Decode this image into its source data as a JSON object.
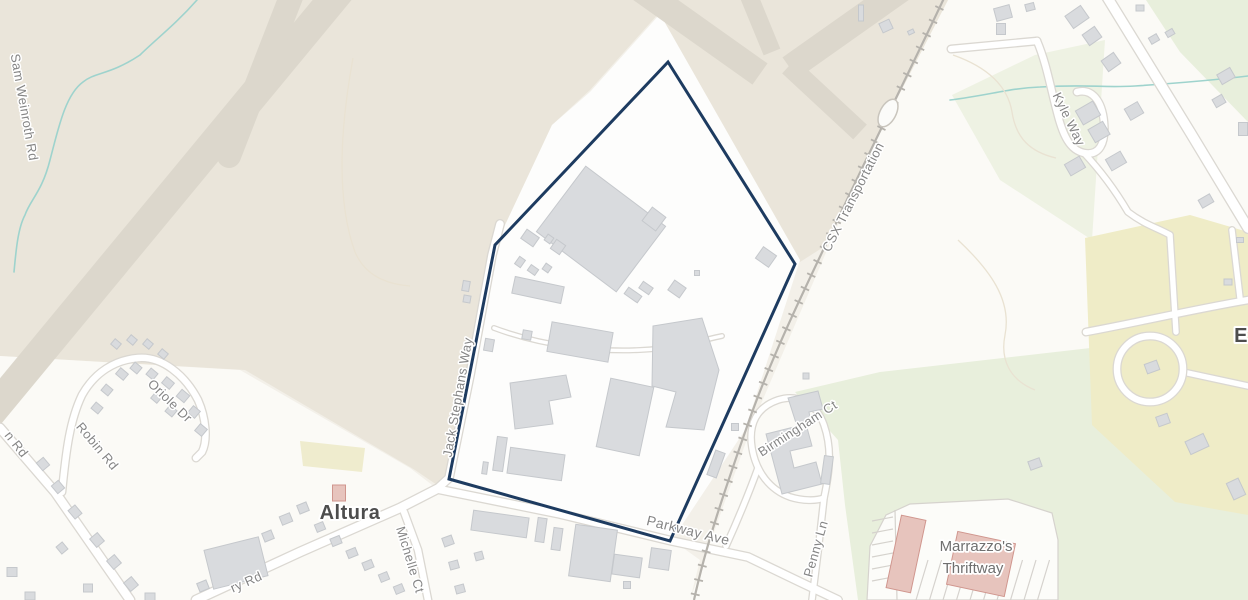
{
  "colors": {
    "base": "#f3f0e9",
    "urban": "#fbfaf6",
    "site": "#fdfdfc",
    "airport": "#eae5da",
    "runway": "#dcd7cc",
    "green": "#e8efdc",
    "green_pale": "#eef2e3",
    "yellow": "#efecc7",
    "road_fill": "#ffffff",
    "road_casing": "#dbd8d2",
    "rail": "#b5b2ac",
    "stream": "#9ed3cd",
    "contour": "#e9e2d2",
    "bld_fill": "#d9dbde",
    "bld_stroke": "#c5c8cc",
    "pink_fill": "#e7c4bd",
    "pink_stroke": "#d0968e",
    "boundary": "#1d3b60",
    "street_label": "#858585",
    "place_label": "#4d4d4d",
    "poi_label": "#6f6f6f"
  },
  "labels": {
    "place": [
      {
        "id": "altura",
        "text": "Altura"
      },
      {
        "id": "e-partial",
        "text": "E"
      }
    ],
    "streets": [
      {
        "id": "sam-weinroth-rd",
        "text": "Sam Weinroth Rd"
      },
      {
        "id": "oriole-dr",
        "text": "Oriole Dr"
      },
      {
        "id": "robin-rd",
        "text": "Robin Rd"
      },
      {
        "id": "n-rd-partial",
        "text": "n Rd"
      },
      {
        "id": "ry-rd-partial",
        "text": "ry Rd"
      },
      {
        "id": "michelle-ct",
        "text": "Michelle Ct"
      },
      {
        "id": "jack-stephans-way",
        "text": "Jack Stephans Way"
      },
      {
        "id": "parkway-ave",
        "text": "Parkway Ave"
      },
      {
        "id": "birmingham-ct",
        "text": "Birmingham Ct"
      },
      {
        "id": "penny-ln",
        "text": "Penny Ln"
      },
      {
        "id": "kyle-way",
        "text": "Kyle Way"
      }
    ],
    "railroad": {
      "text": "CSX Transportation"
    },
    "poi": {
      "line1": "Marrazzo's",
      "line2": "Thriftway"
    }
  },
  "site_boundary": {
    "color": "#1d3b60",
    "points": "668,62 795,264 670,541 449,479 495,245"
  }
}
